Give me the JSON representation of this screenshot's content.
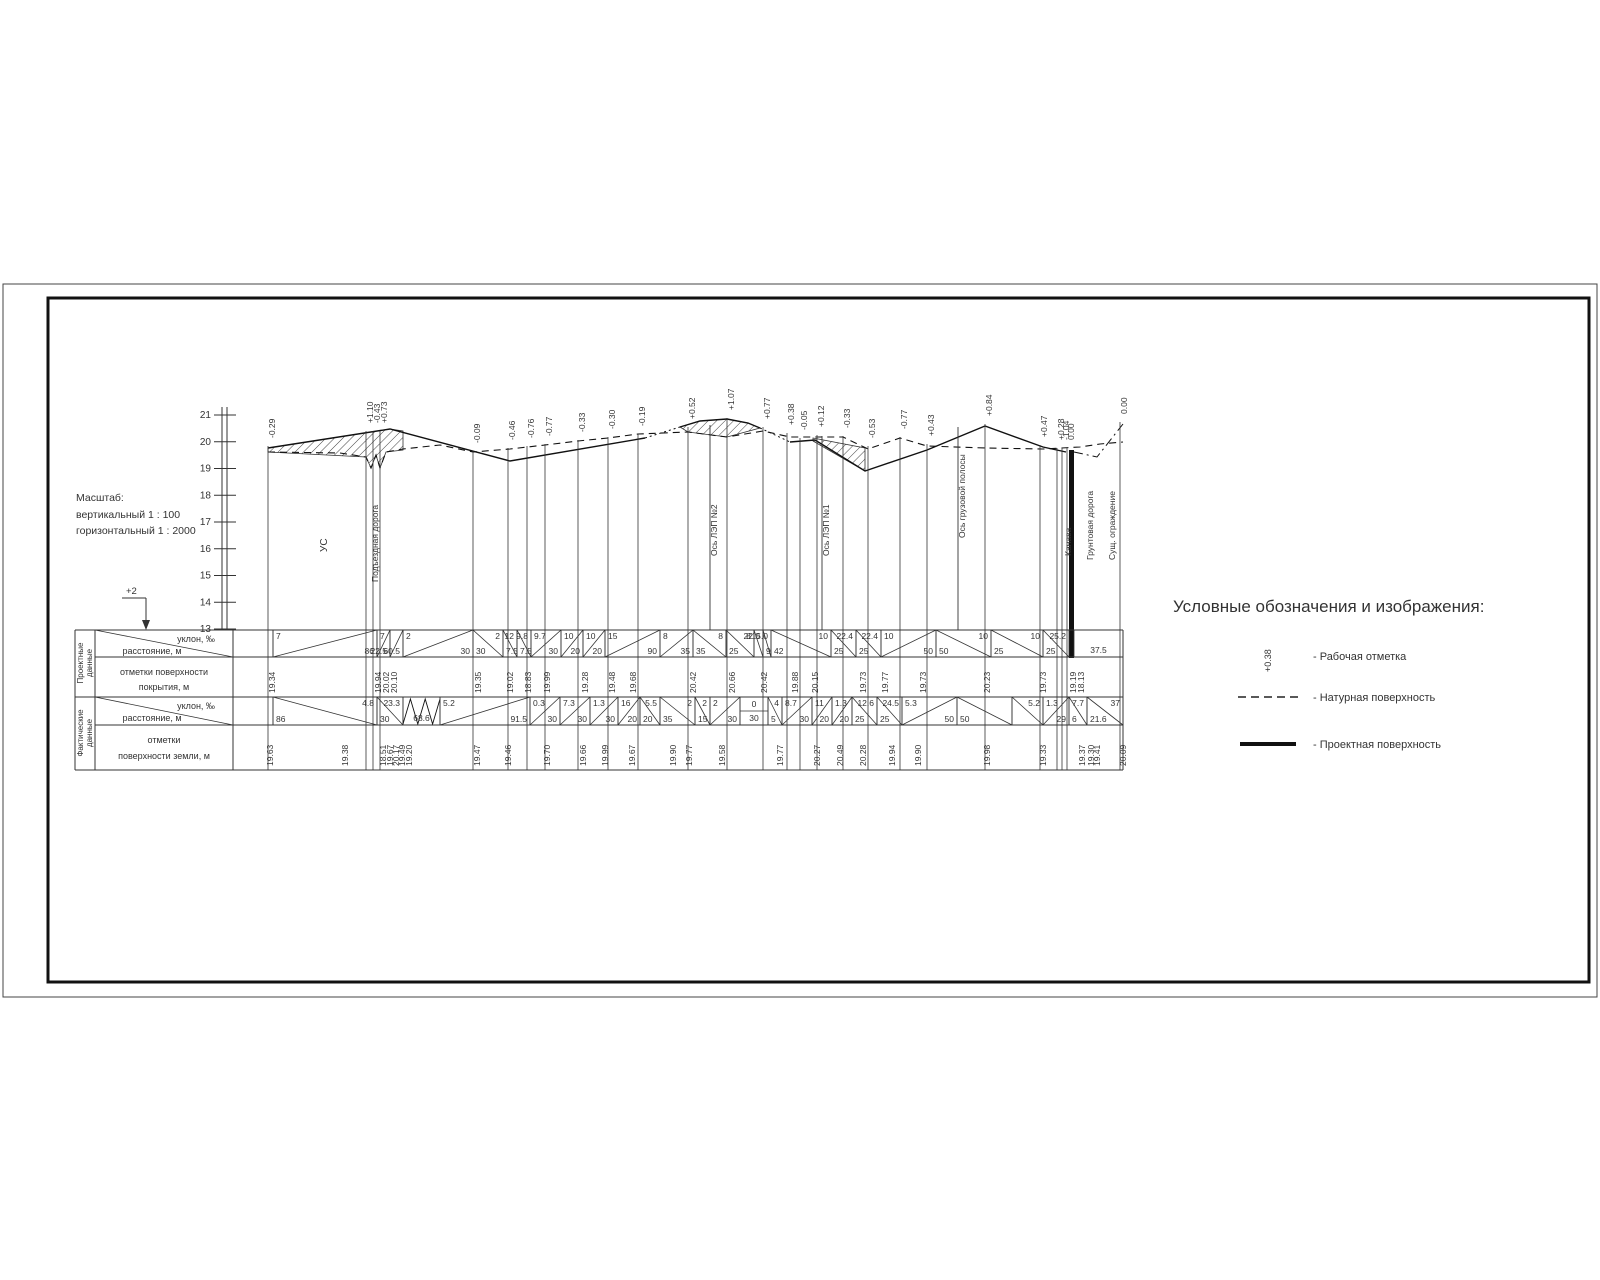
{
  "scale_note": {
    "line1": "Масштаб:",
    "line2": "вертикальный 1 : 100",
    "line3": "горизонтальный 1 : 2000"
  },
  "marker": {
    "label": "+2"
  },
  "axis": {
    "values": [
      "21",
      "20",
      "19",
      "18",
      "17",
      "16",
      "15",
      "14",
      "13"
    ]
  },
  "legend": {
    "title": "Условные обозначения и изображения:",
    "work_mark_symbol": "+0.38",
    "items": [
      {
        "label": "- Рабочая отметка"
      },
      {
        "label": "- Натурная поверхность"
      },
      {
        "label": "- Проектная поверхность"
      }
    ]
  },
  "features": [
    {
      "x": 320,
      "y": 552,
      "label": "УС",
      "line": 0,
      "size": 10
    },
    {
      "x": 371,
      "y": 582,
      "label": "Подъездная дорога",
      "line": 0,
      "size": 8.5
    },
    {
      "x": 710,
      "y": 556,
      "label": "Ось ЛЭП №2",
      "line": 1,
      "t": 425,
      "size": 8.5
    },
    {
      "x": 822,
      "y": 556,
      "label": "Ось ЛЭП №1",
      "line": 1,
      "t": 436,
      "size": 8.5
    },
    {
      "x": 958,
      "y": 538,
      "label": "Ось грузовой полосы",
      "line": 1,
      "t": 427,
      "size": 8.5
    },
    {
      "x": 1064,
      "y": 556,
      "label": "Канава",
      "line": 0,
      "size": 8.5
    },
    {
      "x": 1086,
      "y": 560,
      "label": "Грунтовая дорога",
      "line": 0,
      "size": 8.5
    },
    {
      "x": 1108,
      "y": 560,
      "label": "Сущ. ограждение",
      "line": 0,
      "size": 8.5
    }
  ],
  "stations": [
    {
      "x": 268,
      "t": 446,
      "mark": "-0.29"
    },
    {
      "x": 366,
      "t": 431,
      "mark": "+1.10"
    },
    {
      "x": 373,
      "t": 431,
      "mark": "-0.43"
    },
    {
      "x": 380,
      "t": 431,
      "mark": "+0.73"
    },
    {
      "x": 473,
      "t": 451,
      "mark": "-0.09"
    },
    {
      "x": 508,
      "t": 448,
      "mark": "-0.46"
    },
    {
      "x": 527,
      "t": 446,
      "mark": "-0.76"
    },
    {
      "x": 545,
      "t": 444,
      "mark": "-0.77"
    },
    {
      "x": 578,
      "t": 440,
      "mark": "-0.33"
    },
    {
      "x": 608,
      "t": 437,
      "mark": "-0.30"
    },
    {
      "x": 638,
      "t": 434,
      "mark": "-0.19"
    },
    {
      "x": 688,
      "t": 427,
      "mark": "+0.52"
    },
    {
      "x": 727,
      "t": 418,
      "mark": "+1.07"
    },
    {
      "x": 763,
      "t": 427,
      "mark": "+0.77"
    },
    {
      "x": 787,
      "t": 433,
      "mark": "+0.38"
    },
    {
      "x": 800,
      "t": 438,
      "mark": "-0.05"
    },
    {
      "x": 817,
      "t": 435,
      "mark": "+0.12"
    },
    {
      "x": 843,
      "t": 436,
      "mark": "-0.33"
    },
    {
      "x": 868,
      "t": 446,
      "mark": "-0.53"
    },
    {
      "x": 900,
      "t": 437,
      "mark": "-0.77"
    },
    {
      "x": 927,
      "t": 444,
      "mark": "+0.43"
    },
    {
      "x": 985,
      "t": 424,
      "mark": "+0.84"
    },
    {
      "x": 1040,
      "t": 445,
      "mark": "+0.47"
    },
    {
      "x": 1057,
      "t": 448,
      "mark": "+0.28"
    },
    {
      "x": 1062,
      "t": 448,
      "mark": "-1.04"
    },
    {
      "x": 1067,
      "t": 448,
      "mark": "0.00"
    },
    {
      "x": 1120,
      "t": 422,
      "mark": "0.00"
    }
  ],
  "table": {
    "bands": [
      {
        "word1": "Проектные",
        "word2": "данные"
      },
      {
        "word1": "Фактические",
        "word2": "данные"
      }
    ],
    "headers": {
      "slope": "уклон, ‰",
      "dist": "расстояние, м",
      "design_elev1": "отметки поверхности",
      "design_elev2": "покрытия, м",
      "actual_elev1": "отметки",
      "actual_elev2": "поверхности земли, м"
    },
    "design_cells": [
      [
        233,
        273,
        "",
        "",
        ""
      ],
      [
        273,
        377,
        "7",
        "86",
        "up"
      ],
      [
        377,
        390,
        "7",
        "22.5",
        "up"
      ],
      [
        390,
        403,
        "",
        "60.5",
        "up"
      ],
      [
        403,
        473,
        "2",
        "30",
        "up"
      ],
      [
        473,
        503,
        "2",
        "30",
        "down"
      ],
      [
        503,
        517,
        "12",
        "7.5",
        "down"
      ],
      [
        517,
        531,
        "9.8",
        "7.5",
        "down"
      ],
      [
        531,
        561,
        "9.7",
        "30",
        "up"
      ],
      [
        561,
        583,
        "10",
        "20",
        "up"
      ],
      [
        583,
        605,
        "10",
        "20",
        "up"
      ],
      [
        605,
        660,
        "15",
        "90",
        "up"
      ],
      [
        660,
        693,
        "8",
        "35",
        "up"
      ],
      [
        693,
        726,
        "8",
        "35",
        "down"
      ],
      [
        726,
        754,
        "8",
        "25",
        "down"
      ],
      [
        754,
        763,
        "22.0",
        "",
        "down"
      ],
      [
        763,
        771,
        "15.0",
        "9",
        "down"
      ],
      [
        771,
        831,
        "10",
        "42",
        "down"
      ],
      [
        831,
        856,
        "22.4",
        "25",
        "down"
      ],
      [
        856,
        881,
        "22.4",
        "25",
        "down"
      ],
      [
        881,
        936,
        "10",
        "50",
        "up"
      ],
      [
        936,
        991,
        "10",
        "50",
        "down"
      ],
      [
        991,
        1043,
        "10",
        "25",
        "down"
      ],
      [
        1043,
        1069,
        "25.2",
        "25",
        "down"
      ],
      [
        1074,
        1123,
        "",
        "37.5",
        ""
      ]
    ],
    "actual_cells": [
      [
        233,
        273,
        "",
        "",
        ""
      ],
      [
        273,
        377,
        "4.8",
        "86",
        "down"
      ],
      [
        377,
        403,
        "23.3",
        "30",
        "down"
      ],
      [
        403,
        440,
        "",
        "68.6",
        "zig"
      ],
      [
        440,
        530,
        "5.2",
        "91.5",
        "up"
      ],
      [
        530,
        560,
        "0.3",
        "30",
        "up"
      ],
      [
        560,
        590,
        "7.3",
        "30",
        "up"
      ],
      [
        590,
        618,
        "1.3",
        "30",
        "up"
      ],
      [
        618,
        640,
        "16",
        "20",
        "up"
      ],
      [
        640,
        660,
        "5.5",
        "20",
        "down"
      ],
      [
        660,
        695,
        "2",
        "35",
        "down"
      ],
      [
        695,
        710,
        "2",
        "15",
        "down"
      ],
      [
        710,
        740,
        "2",
        "30",
        "up"
      ],
      [
        740,
        768,
        "0",
        "30",
        "flat"
      ],
      [
        768,
        782,
        "4",
        "5",
        "down"
      ],
      [
        782,
        812,
        "8.7",
        "30",
        "up"
      ],
      [
        812,
        832,
        "11",
        "20",
        "up"
      ],
      [
        832,
        852,
        "1.3",
        "20",
        "up"
      ],
      [
        852,
        877,
        "12.6",
        "25",
        "down"
      ],
      [
        877,
        902,
        "24.5",
        "25",
        "down"
      ],
      [
        902,
        957,
        "5.3",
        "50",
        "up"
      ],
      [
        957,
        1012,
        "",
        "50",
        "down"
      ],
      [
        1012,
        1043,
        "5.2",
        "",
        "down"
      ],
      [
        1043,
        1069,
        "1.3",
        "29",
        "up"
      ],
      [
        1069,
        1087,
        "7.7",
        "6",
        "down"
      ],
      [
        1087,
        1123,
        "37",
        "21.6",
        "down"
      ]
    ],
    "design_elevations": [
      [
        267,
        "19.34"
      ],
      [
        373,
        "19.94"
      ],
      [
        381,
        "20.02"
      ],
      [
        389,
        "20.10"
      ],
      [
        473,
        "19.35"
      ],
      [
        505,
        "19.02"
      ],
      [
        523,
        "18.83"
      ],
      [
        542,
        "19.99"
      ],
      [
        580,
        "19.28"
      ],
      [
        607,
        "19.48"
      ],
      [
        628,
        "19.68"
      ],
      [
        688,
        "20.42"
      ],
      [
        727,
        "20.66"
      ],
      [
        759,
        "20.42"
      ],
      [
        790,
        "19.88"
      ],
      [
        810,
        "20.15"
      ],
      [
        858,
        "19.73"
      ],
      [
        880,
        "19.77"
      ],
      [
        918,
        "19.73"
      ],
      [
        982,
        "20.23"
      ],
      [
        1038,
        "19.73"
      ],
      [
        1068,
        "19.19"
      ],
      [
        1076,
        "18.13"
      ]
    ],
    "actual_elevations": [
      [
        265,
        "19.63"
      ],
      [
        340,
        "19.38"
      ],
      [
        378,
        "18.51"
      ],
      [
        385,
        "19.67"
      ],
      [
        391,
        "20.17"
      ],
      [
        397,
        "19.49"
      ],
      [
        404,
        "19.20"
      ],
      [
        472,
        "19.47"
      ],
      [
        503,
        "19.46"
      ],
      [
        542,
        "19.70"
      ],
      [
        578,
        "19.66"
      ],
      [
        600,
        "19.99"
      ],
      [
        627,
        "19.67"
      ],
      [
        668,
        "19.90"
      ],
      [
        684,
        "19.77"
      ],
      [
        717,
        "19.58"
      ],
      [
        775,
        "19.77"
      ],
      [
        812,
        "20.27"
      ],
      [
        835,
        "20.49"
      ],
      [
        858,
        "20.28"
      ],
      [
        887,
        "19.94"
      ],
      [
        913,
        "19.90"
      ],
      [
        982,
        "19.98"
      ],
      [
        1038,
        "19.33"
      ],
      [
        1077,
        "19.37"
      ],
      [
        1086,
        "19.30"
      ],
      [
        1092,
        "19.41"
      ],
      [
        1118,
        "20.09"
      ]
    ]
  },
  "profile": {
    "solid": [
      [
        [
          268,
          448
        ],
        [
          390,
          429
        ],
        [
          510,
          461
        ],
        [
          645,
          438
        ]
      ],
      [
        [
          680,
          427
        ],
        [
          700,
          421
        ],
        [
          727,
          419
        ],
        [
          748,
          423
        ],
        [
          760,
          428
        ]
      ],
      [
        [
          790,
          442
        ],
        [
          815,
          440
        ],
        [
          865,
          471
        ],
        [
          927,
          450
        ],
        [
          985,
          426
        ],
        [
          1043,
          447
        ],
        [
          1066,
          452
        ]
      ]
    ],
    "dashed": [
      [
        [
          268,
          452
        ],
        [
          340,
          453
        ],
        [
          366,
          457
        ],
        [
          371,
          468
        ],
        [
          376,
          455
        ],
        [
          380,
          468
        ],
        [
          386,
          452
        ],
        [
          403,
          449
        ],
        [
          440,
          445
        ],
        [
          473,
          452
        ],
        [
          510,
          449
        ],
        [
          545,
          445
        ],
        [
          578,
          441
        ],
        [
          608,
          438
        ],
        [
          638,
          434
        ],
        [
          688,
          432
        ],
        [
          727,
          437
        ],
        [
          763,
          431
        ],
        [
          790,
          437
        ],
        [
          843,
          437
        ],
        [
          868,
          449
        ],
        [
          900,
          438
        ],
        [
          927,
          446
        ],
        [
          985,
          448
        ],
        [
          1043,
          449
        ],
        [
          1080,
          447
        ],
        [
          1100,
          444
        ],
        [
          1123,
          442
        ]
      ]
    ],
    "dotted": [
      [
        [
          645,
          438
        ],
        [
          680,
          427
        ]
      ],
      [
        [
          760,
          428
        ],
        [
          790,
          442
        ]
      ]
    ],
    "dashdot": [
      [
        [
          1074,
          452
        ],
        [
          1097,
          457
        ],
        [
          1123,
          424
        ]
      ]
    ],
    "hatch_polygons": [
      [
        [
          268,
          448
        ],
        [
          390,
          429
        ],
        [
          403,
          431
        ],
        [
          403,
          450
        ],
        [
          386,
          452
        ],
        [
          380,
          468
        ],
        [
          376,
          455
        ],
        [
          371,
          468
        ],
        [
          366,
          457
        ],
        [
          268,
          452
        ]
      ],
      [
        [
          680,
          427
        ],
        [
          700,
          421
        ],
        [
          727,
          419
        ],
        [
          748,
          423
        ],
        [
          760,
          428
        ],
        [
          727,
          437
        ],
        [
          688,
          432
        ]
      ],
      [
        [
          813,
          438
        ],
        [
          865,
          448
        ],
        [
          865,
          471
        ],
        [
          813,
          441
        ]
      ]
    ],
    "canal": {
      "x": 1069,
      "y": 450,
      "w": 5,
      "h": 208
    }
  }
}
